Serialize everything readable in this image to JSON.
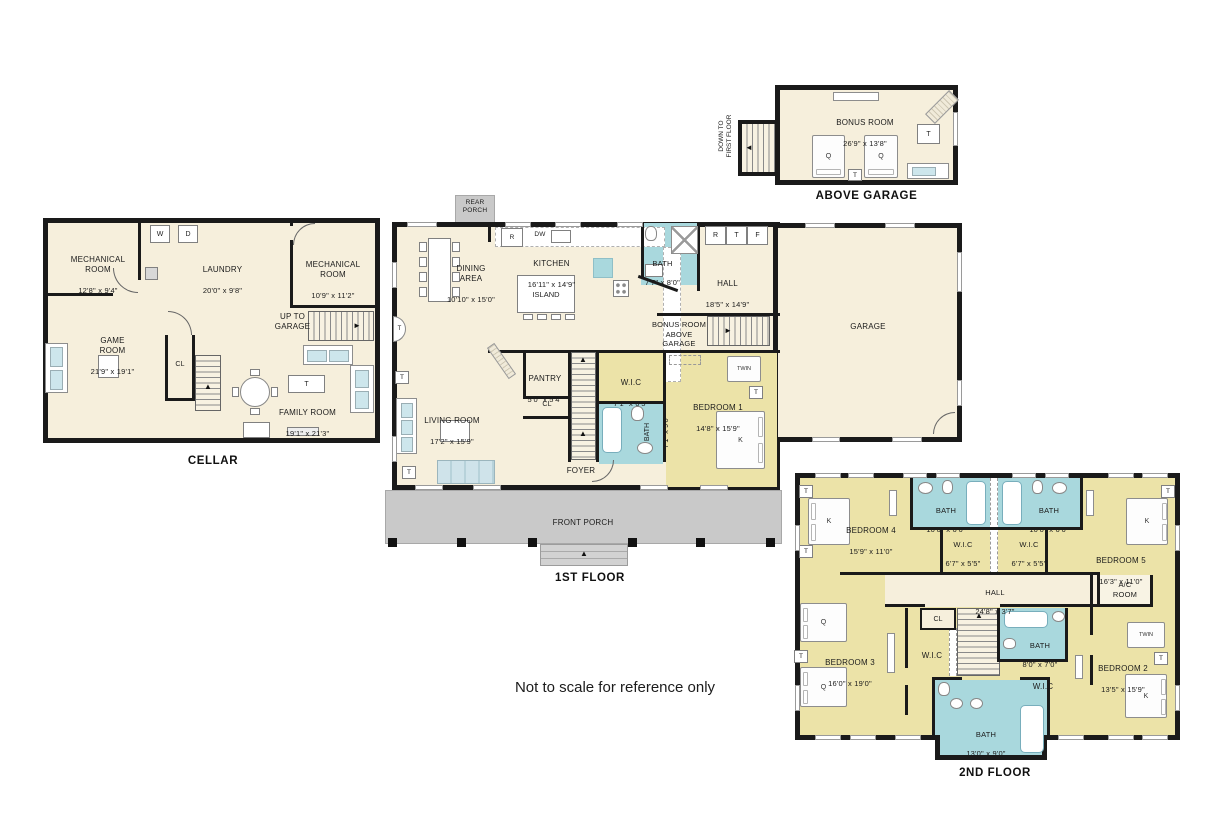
{
  "note": "Not to scale for reference only",
  "colors": {
    "wall": "#1a1a1a",
    "room_cream": "#f6efdc",
    "room_yellow": "#ece3a8",
    "bath_blue": "#a9d8dd",
    "porch_gray": "#c9c9c9"
  },
  "legend": {
    "w": "W",
    "d": "D",
    "r": "R",
    "dw": "DW",
    "t": "T",
    "f": "F",
    "k": "K",
    "q": "Q",
    "twin": "TWIN",
    "cl": "CL"
  },
  "floors": {
    "above_garage": {
      "title": "ABOVE GARAGE",
      "stairs_label": "DOWN TO\nFIRST FLOOR",
      "bonus": {
        "name": "BONUS ROOM",
        "dims": "26'9\" x 13'8\""
      }
    },
    "cellar": {
      "title": "CELLAR",
      "stairs_label": "UP TO\nGARAGE",
      "mech1": {
        "name": "MECHANICAL\nROOM",
        "dims": "12'8\" x 9'4\""
      },
      "laundry": {
        "name": "LAUNDRY",
        "dims": "20'0\" x 9'8\""
      },
      "mech2": {
        "name": "MECHANICAL\nROOM",
        "dims": "10'9\" x 11'2\""
      },
      "game": {
        "name": "GAME\nROOM",
        "dims": "21'9\" x 19'1\""
      },
      "family": {
        "name": "FAMILY ROOM",
        "dims": "19'1\" x 21'3\""
      }
    },
    "first": {
      "title": "1ST FLOOR",
      "rear_porch": "REAR\nPORCH",
      "front_porch": "FRONT PORCH",
      "dining": {
        "name": "DINING\nAREA",
        "dims": "10'10\" x 15'0\""
      },
      "kitchen": {
        "name": "KITCHEN",
        "dims": "16'11\" x 14'9\""
      },
      "island": "ISLAND",
      "bath_top": {
        "name": "BATH",
        "dims": "7'7\" x 8'0\""
      },
      "hall": {
        "name": "HALL",
        "dims": "18'5\" x 14'9\""
      },
      "garage": "GARAGE",
      "bonus_stairs": "BONUS ROOM\nABOVE\nGARAGE",
      "living": {
        "name": "LIVING ROOM",
        "dims": "17'2\" x 15'9\""
      },
      "pantry": {
        "name": "PANTRY",
        "dims": "5'0\" x 5'4\""
      },
      "wic": {
        "name": "W.I.C",
        "dims": "7'1\" x 6'5\""
      },
      "bath_down": {
        "name": "BATH",
        "dims": "7'1\" x 9'0\""
      },
      "foyer": {
        "name": "FOYER",
        "dims": "9'10\" x 9'8\""
      },
      "bedroom1": {
        "name": "BEDROOM 1",
        "dims": "14'8\" x 15'9\""
      }
    },
    "second": {
      "title": "2ND FLOOR",
      "bedroom4": {
        "name": "BEDROOM 4",
        "dims": "15'9\" x 11'0\""
      },
      "bath_left": {
        "name": "BATH",
        "dims": "10'0\" x 6'6\""
      },
      "bath_right": {
        "name": "BATH",
        "dims": "10'0\" x 6'6\""
      },
      "wic_left": {
        "name": "W.I.C",
        "dims": "6'7\" x 5'5\""
      },
      "wic_right": {
        "name": "W.I.C",
        "dims": "6'7\" x 5'5\""
      },
      "bedroom5": {
        "name": "BEDROOM 5",
        "dims": "16'3\" x 11'0\""
      },
      "hall": {
        "name": "HALL",
        "dims": "24'8\" x 3'7\""
      },
      "ac_room": "A/C\nROOM",
      "bedroom3": {
        "name": "BEDROOM 3",
        "dims": "16'0\" x 19'0\""
      },
      "bath_mid": {
        "name": "BATH",
        "dims": "8'0\" x 7'0\""
      },
      "wic3": "W.I.C",
      "wic2": "W.I.C",
      "bedroom2": {
        "name": "BEDROOM 2",
        "dims": "13'5\" x 15'9\""
      },
      "bath_bottom": {
        "name": "BATH",
        "dims": "13'0\" x 9'0\""
      }
    }
  }
}
